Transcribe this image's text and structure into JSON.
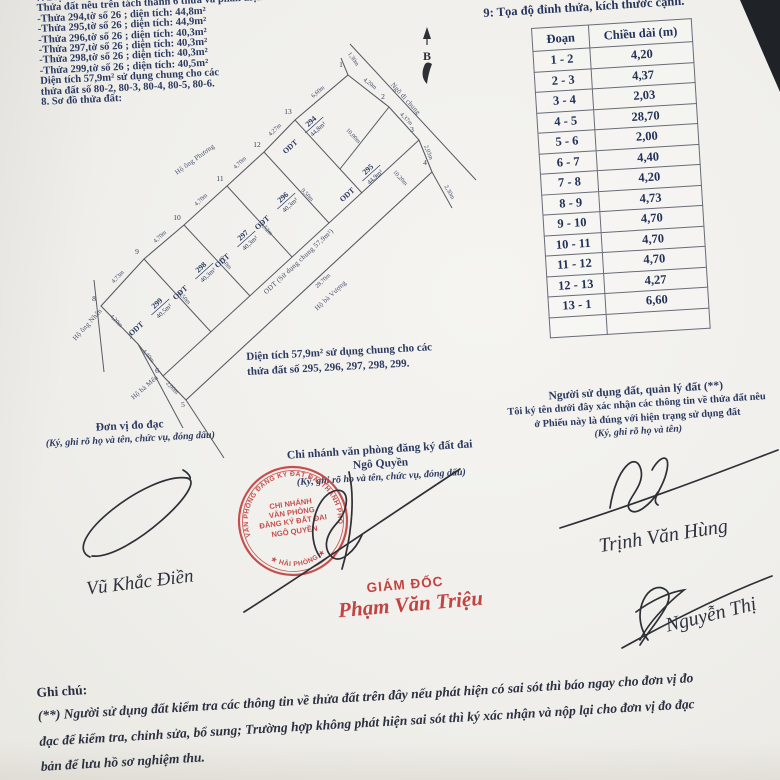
{
  "document": {
    "section7": {
      "lines": [
        "7. Diện tích, loại đất sau đo đạc chỉnh lý:",
        "Thửa đất nêu trên tách thành 6 thửa và phần diện tích sử dụng chung :",
        "-Thửa 294,tờ số 26 ; diện tích: 44,8m²",
        "-Thửa 295,tờ số 26 ; diện tích: 44,9m²",
        "-Thửa 296,tờ số 26 ; diện tích: 40,3m²",
        "-Thửa 297,tờ số 26 ; diện tích: 40,3m²",
        "-Thửa 298,tờ số 26 ; diện tích: 40,3m²",
        "-Thửa 299,tờ số 26 ; diện tích: 40,5m²",
        "Diện tích 57,9m² sử dụng chung cho các",
        "thửa đất số 80-2, 80-3, 80-4, 80-5, 80-6.",
        "8. Sơ đồ thửa đất:"
      ]
    },
    "north_label": "B",
    "section9_title": "9: Tọa độ đỉnh thửa, kích thước cạnh.",
    "table": {
      "col1": "Đoạn",
      "col2": "Chiều dài (m)",
      "rows": [
        [
          "1 - 2",
          "4,20"
        ],
        [
          "2 - 3",
          "4,37"
        ],
        [
          "3 - 4",
          "2,03"
        ],
        [
          "4 - 5",
          "28,70"
        ],
        [
          "5 - 6",
          "2,00"
        ],
        [
          "6 - 7",
          "4,40"
        ],
        [
          "7 - 8",
          "4,20"
        ],
        [
          "8 - 9",
          "4,73"
        ],
        [
          "9 - 10",
          "4,70"
        ],
        [
          "10 - 11",
          "4,70"
        ],
        [
          "11 - 12",
          "4,70"
        ],
        [
          "12 - 13",
          "4,27"
        ],
        [
          "13 - 1",
          "6,60"
        ],
        [
          "",
          ""
        ]
      ]
    },
    "note_under_diagram": [
      "Diện tích 57,9m² sử dụng chung cho các",
      "thửa đất số 295, 296, 297, 298, 299."
    ],
    "signer_left": {
      "title": "Đơn vị đo đạc",
      "subtitle": "(Ký, ghi rõ họ và tên, chức vụ, đóng dấu)",
      "handwritten_name": "Vũ Khắc Điền"
    },
    "signer_mid": {
      "title_line1": "Chi nhánh văn phòng đăng ký đất đai",
      "title_line2": "Ngô Quyền",
      "subtitle": "(Ký, ghi rõ họ và tên, chức vụ, đóng dấu)",
      "director_label": "GIÁM ĐỐC",
      "director_name": "Phạm Văn Triệu"
    },
    "signer_right": {
      "title": "Người sử dụng đất, quản lý đất (**)",
      "line2": "Tôi ký tên dưới đây xác nhận các thông tin về thửa đất nêu",
      "line3": "ở Phiếu này là đúng với hiện trạng sử dụng đất",
      "subtitle": "(Ký, ghi rõ họ và tên)",
      "handwritten_name1": "Trịnh Văn Hùng",
      "handwritten_name2": "Nguyễn Thị"
    },
    "stamp": {
      "ring_top": "VĂN PHÒNG ĐĂNG KÝ ĐẤT ĐAI THÀNH PHỐ",
      "ring_bottom": "★ HẢI PHÒNG ★",
      "center_lines": [
        "CHI NHÁNH",
        "VĂN PHÒNG",
        "ĐĂNG KÝ ĐẤT ĐAI",
        "NGÔ QUYỀN"
      ]
    },
    "notes": {
      "label": "Ghi chú:",
      "lines": [
        "(**) Người sử dụng đất kiểm tra các thông tin về thửa đất trên đây nếu phát hiện có sai sót thì báo ngay cho đơn vị đo",
        "đạc để kiểm tra, chỉnh sửa, bổ sung; Trường hợp không phát hiện sai sót thì ký xác nhận và nộp lại cho đơn vị đo đạc",
        "bản để lưu hồ sơ nghiệm thu."
      ]
    }
  },
  "diagram": {
    "land_code": "ODT",
    "outline": [
      [
        348,
        75
      ],
      [
        389,
        107
      ],
      [
        419,
        140
      ],
      [
        432,
        172
      ],
      [
        186,
        400
      ],
      [
        163,
        376
      ],
      [
        138,
        344
      ],
      [
        101,
        306
      ],
      [
        144,
        259
      ],
      [
        184,
        225
      ],
      [
        227,
        186
      ],
      [
        264,
        152
      ],
      [
        295,
        120
      ]
    ],
    "lines": [
      [
        419,
        140,
        163,
        376
      ],
      [
        295,
        120,
        362,
        193
      ],
      [
        264,
        152,
        329,
        223
      ],
      [
        227,
        186,
        292,
        257
      ],
      [
        184,
        225,
        250,
        296
      ],
      [
        144,
        259,
        211,
        332
      ],
      [
        389,
        107,
        340,
        169
      ],
      [
        348,
        75,
        341,
        58
      ],
      [
        432,
        172,
        452,
        208
      ],
      [
        350,
        44,
        476,
        180
      ],
      [
        94,
        280,
        104,
        372
      ],
      [
        138,
        344,
        183,
        428
      ],
      [
        186,
        400,
        224,
        458
      ]
    ],
    "vertices": [
      {
        "n": "1",
        "x": 341,
        "y": 67
      },
      {
        "n": "2",
        "x": 383,
        "y": 99
      },
      {
        "n": "3",
        "x": 412,
        "y": 132
      },
      {
        "n": "4",
        "x": 425,
        "y": 165
      },
      {
        "n": "5",
        "x": 183,
        "y": 407
      },
      {
        "n": "6",
        "x": 157,
        "y": 373
      },
      {
        "n": "7",
        "x": 131,
        "y": 339
      },
      {
        "n": "8",
        "x": 94,
        "y": 301
      },
      {
        "n": "9",
        "x": 137,
        "y": 254
      },
      {
        "n": "10",
        "x": 177,
        "y": 220
      },
      {
        "n": "11",
        "x": 220,
        "y": 181
      },
      {
        "n": "12",
        "x": 257,
        "y": 147
      },
      {
        "n": "13",
        "x": 288,
        "y": 114
      }
    ],
    "parcels": [
      {
        "num": "294",
        "area": "44,8m²",
        "x": 308,
        "y": 130
      },
      {
        "num": "295",
        "area": "44,9m²",
        "x": 365,
        "y": 178
      },
      {
        "num": "296",
        "area": "40,3m²",
        "x": 280,
        "y": 206
      },
      {
        "num": "297",
        "area": "40,3m²",
        "x": 240,
        "y": 244
      },
      {
        "num": "298",
        "area": "40,3m²",
        "x": 198,
        "y": 276
      },
      {
        "num": "299",
        "area": "40,5m²",
        "x": 154,
        "y": 312
      }
    ],
    "strip_label": {
      "t": "ODT (Sử dụng chung 57,9m²)",
      "x": 300,
      "y": 263,
      "r": -43
    },
    "dims": [
      {
        "t": "1,30m",
        "x": 352,
        "y": 60,
        "r": 55
      },
      {
        "t": "4,20m",
        "x": 369,
        "y": 85,
        "r": 38
      },
      {
        "t": "4,37m",
        "x": 405,
        "y": 120,
        "r": 45
      },
      {
        "t": "2,03m",
        "x": 427,
        "y": 153,
        "r": 68
      },
      {
        "t": "2,30m",
        "x": 448,
        "y": 193,
        "r": 60
      },
      {
        "t": "6,60m",
        "x": 319,
        "y": 93,
        "r": -41
      },
      {
        "t": "4,27m",
        "x": 276,
        "y": 131,
        "r": -44
      },
      {
        "t": "4,70m",
        "x": 241,
        "y": 164,
        "r": -43
      },
      {
        "t": "4,70m",
        "x": 202,
        "y": 201,
        "r": -42
      },
      {
        "t": "4,70m",
        "x": 161,
        "y": 238,
        "r": -42
      },
      {
        "t": "4,73m",
        "x": 119,
        "y": 278,
        "r": -46
      },
      {
        "t": "4,20m",
        "x": 115,
        "y": 322,
        "r": 46
      },
      {
        "t": "4,40m",
        "x": 147,
        "y": 357,
        "r": 50
      },
      {
        "t": "2,00m",
        "x": 171,
        "y": 389,
        "r": 46
      },
      {
        "t": "28,70m",
        "x": 324,
        "y": 282,
        "r": -43
      },
      {
        "t": "10,00m",
        "x": 352,
        "y": 137,
        "r": 47
      },
      {
        "t": "10,20m",
        "x": 399,
        "y": 179,
        "r": 47
      },
      {
        "t": "9,50m",
        "x": 306,
        "y": 196,
        "r": 47
      },
      {
        "t": "9,52m",
        "x": 265,
        "y": 230,
        "r": 47
      },
      {
        "t": "9,50m",
        "x": 224,
        "y": 264,
        "r": 47
      },
      {
        "t": "9,50m",
        "x": 183,
        "y": 299,
        "r": 47
      }
    ],
    "neighbors": [
      {
        "t": "Ngõ đi chung",
        "x": 404,
        "y": 100,
        "r": 48
      },
      {
        "t": "Hộ ông Phương",
        "x": 196,
        "y": 161,
        "r": -36
      },
      {
        "t": "Hộ ông Nhân",
        "x": 89,
        "y": 326,
        "r": -48
      },
      {
        "t": "Hộ bà Mến",
        "x": 146,
        "y": 389,
        "r": -41
      },
      {
        "t": "Hộ bà Vượng",
        "x": 332,
        "y": 297,
        "r": -43
      }
    ]
  },
  "colors": {
    "ink": "#2c3a60",
    "line": "#595b63",
    "red": "#c14442",
    "pen": "#2e3037",
    "paper": "#f0efeb"
  }
}
